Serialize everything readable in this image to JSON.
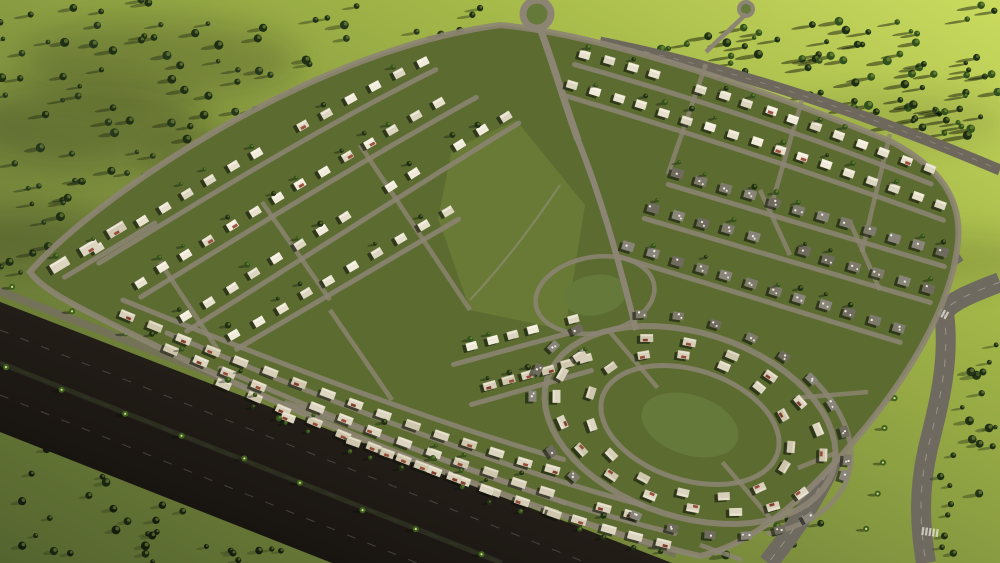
{
  "scene": {
    "type": "aerial-architectural-rendering",
    "subject": "Master-planned suburban residential compound seen from a high oblique aerial view",
    "time_of_day": "Late afternoon, warm low sun from the upper right, drifting cloud and ground haze",
    "regions": {
      "development": "Diamond-shaped walled community of white villas and townhouses on looping tree-lined streets",
      "left_villa_rows": "Parallel diagonal rows of white apartment-villas on the north-west half",
      "bottom_townhouse_rows": "Long townhouse terraces with terracotta roof accents along the highway edge",
      "right_gray_rows": "Rows of dark flat-roofed houses on the east block",
      "oval_cluster": "Concentric oval street loops of houses around a central lawn in the south-east quarter",
      "central_park": "Linear park with red flowering flame trees near the centre",
      "entrance": "North entrance roundabout with gatehouse buildings with red roofs and a sand-coloured court",
      "clubhouse_pool": "Clubhouse with blue swimming pool and red- and blue-roofed pavilions on the north-east row",
      "highway": "Very dark multi-lane highway with palm median crossing the south-west corner",
      "dual_carriageway": "Divided road pair with wide grass median curving along the south-east edge",
      "boulevard": "Tree-lined boulevard along the north-east boundary",
      "fields": "Open yellow-green fields dotted with trees casting long shadows",
      "clouds": "White cloud patches over the corners and mist streaks near the ground"
    }
  },
  "palette": {
    "field_dark": "#54642f",
    "field_mid": "#7d8f3e",
    "field_bright": "#a3b748",
    "field_glow": "#cadb5f",
    "dev_green": "#5c6c31",
    "park_green": "#687b36",
    "lawn_green": "#64793a",
    "street": "#8d8574",
    "street_light": "#9a9280",
    "street_shaded": "#6e685c",
    "highway_dark": "#0e0b08",
    "highway_mid": "#241f19",
    "highway_edge": "#35302a",
    "frontage": "#766f60",
    "carriageway": "#6f6a60",
    "median_green": "#77893c",
    "house_light": "#e7e0cd",
    "house_light2": "#dcd5c0",
    "house_light3": "#f0eadb",
    "house_town": "#d8cfba",
    "house_gray": "#7e7a6c",
    "house_gray2": "#6f6b5e",
    "house_shadow": "rgba(16,20,10,0.6)",
    "roof_red": "#93402e",
    "roof_red_dark": "#7c3020",
    "tree_dark": "#1e2f13",
    "tree_mid": "#33511c",
    "tree_palm": "#3f601f",
    "red_tree": "#ad4527",
    "red_tree_dark": "#8a3119",
    "pool_blue": "#2e74b4",
    "deck": "#ded7c6",
    "court_sand": "#c9a369",
    "court_sand_light": "#e4cf9a",
    "blue_roof": "#31598f",
    "cloud": "#ffffff",
    "lane_mark": "#d8d3c6",
    "car_white": "#d9d5cb",
    "car_dark": "#26282b",
    "car_red": "#b03326"
  }
}
